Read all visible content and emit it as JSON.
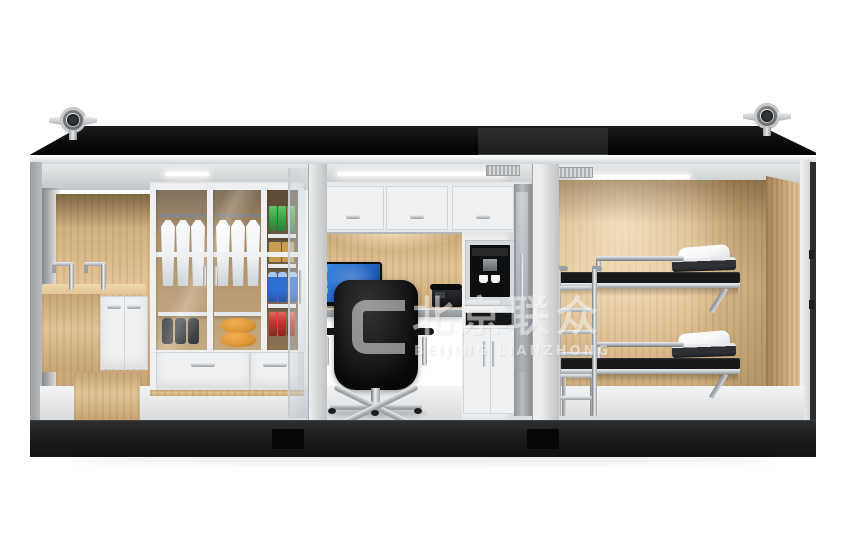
{
  "scene": {
    "type": "3d-cutaway-render",
    "subject": "modular container living unit with washroom, office and bunk room"
  },
  "watermark": {
    "logo": "rounded-bracket-frame",
    "cjk": "北京联众",
    "latin": "BEIJING LIANZHONG"
  },
  "rooms": [
    {
      "name": "washroom-storage",
      "fixtures": [
        "double-faucet wood vanity",
        "white under-sink cabinet",
        "glass-door wardrobe with hanging towels",
        "work boots",
        "orange hard hats",
        "snack and noodle shelf",
        "water bottles",
        "red cans",
        "two drawers"
      ]
    },
    {
      "name": "office",
      "fixtures": [
        "overhead cabinets",
        "wood back wall with under-cabinet light",
        "wall-mounted desk",
        "monitor with blue desktop",
        "black executive chair",
        "desk phone",
        "built-in coffee machine with two cups",
        "tall storage cabinet",
        "glass entry door"
      ]
    },
    {
      "name": "bunk-room",
      "fixtures": [
        "wood wall paneling",
        "two wall-mounted bunk beds",
        "black mattresses",
        "white pillows",
        "folded dark blankets",
        "stainless steel ladder"
      ]
    }
  ],
  "exterior": {
    "features": [
      "black roof",
      "two chrome roof vent fans",
      "rooftop unit",
      "white fascia",
      "ceiling LED strips",
      "air vents",
      "dark chassis base",
      "two forklift pockets"
    ]
  },
  "palette": {
    "bg": "#ffffff",
    "roof-a": "#1c1c1e",
    "roof-b": "#030304",
    "roof-box": "#232426",
    "fascia-a": "#ffffff",
    "fascia-b": "#d2d5d7",
    "ceiling-a": "#e6e8e9",
    "ceiling-b": "#c3c6c8",
    "led": "#ffffff",
    "grille-a": "#a9aeb2",
    "grille-b": "#d8dbdd",
    "cut-a": "#ecedee",
    "cut-b": "#c0c3c5",
    "wall-gray-a": "#9b9ea1",
    "wall-gray-b": "#b9bcbe",
    "wood-a": "#e3c496",
    "wood-b": "#c7a574",
    "wood-dark": "#a88256",
    "wood-grain": "rgba(110,75,30,0.10)",
    "glow": "rgba(255,242,205,0.85)",
    "cabinet": "#eef0f2",
    "cabinet-line": "#d2d5d7",
    "floor-a": "#f3f4f5",
    "floor-b": "#d9dbdd",
    "base-a": "#2c2e30",
    "base-b": "#121314",
    "pocket": "#060607",
    "chrome-a": "#eef1f3",
    "chrome-b": "#9aa0a5",
    "chrome-c": "#6e7479",
    "glass-a": "rgba(196,206,214,0.55)",
    "glass-b": "rgba(235,241,245,0.35)",
    "screen-a": "#3c8ce8",
    "screen-b": "#0b3ea0",
    "dark-appliance": "#0e0f10",
    "mattress": "#17181a",
    "pillow": "#f6f7f8",
    "blanket": "#2e3033",
    "chair-a": "#323335",
    "chair-b": "#0b0c0d",
    "hat-orange": "#dd8b21",
    "pack-green": "#3fa046",
    "noodle-tan": "#c89d4e",
    "bottle-blue": "#2f6fd0",
    "can-red": "#c23a2e",
    "boot-dark": "#27292b",
    "towel": "#f2f4f5",
    "watermark": "rgba(255,255,255,0.5)"
  }
}
